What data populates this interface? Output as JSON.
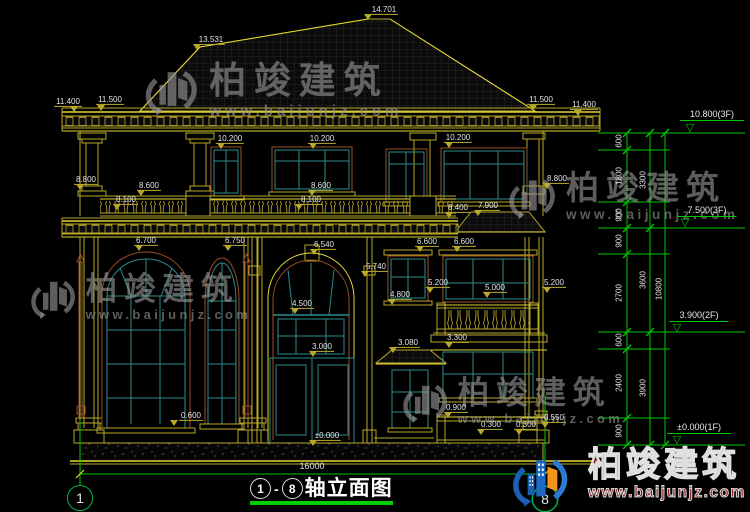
{
  "drawing": {
    "title_axis_start": "1",
    "title_axis_end": "8",
    "title_main": "轴立面图",
    "title_dash": "-",
    "total_width_dim": "16000",
    "axis_start": "1",
    "axis_end": "8"
  },
  "watermark": {
    "brand": "柏竣建筑",
    "url": "www.baijunjz.com"
  },
  "logo": {
    "brand": "柏竣建筑",
    "url": "www.baijunjz.com"
  },
  "colors": {
    "background": "#000000",
    "line_yellow": "#b9a82a",
    "line_bright": "#e2d535",
    "window_teal": "#2e8b8b",
    "frame_brown": "#9a4f28",
    "dim_green": "#00c800",
    "text_white": "#e3e3e3",
    "logo_blue": "#1a5fb4",
    "logo_orange": "#f5941d",
    "logo_red": "#8c1616"
  },
  "watermark_positions": [
    {
      "x": 142,
      "y": 56,
      "s": 1.12
    },
    {
      "x": 506,
      "y": 166,
      "s": 1.0
    },
    {
      "x": 28,
      "y": 268,
      "s": 0.96
    },
    {
      "x": 400,
      "y": 372,
      "s": 0.96
    }
  ],
  "dim_labels": [
    {
      "t": "14.701",
      "x": 384,
      "y": 10,
      "tx": 368,
      "ty": 14
    },
    {
      "t": "13.531",
      "x": 211,
      "y": 40,
      "tx": 197,
      "ty": 44
    },
    {
      "t": "11.400",
      "x": 68,
      "y": 102,
      "tx": 74,
      "ty": 106
    },
    {
      "t": "11.500",
      "x": 110,
      "y": 100,
      "tx": 101,
      "ty": 105
    },
    {
      "t": "11.500",
      "x": 541,
      "y": 100,
      "tx": 533,
      "ty": 105
    },
    {
      "t": "11.400",
      "x": 584,
      "y": 105,
      "tx": 578,
      "ty": 110
    },
    {
      "t": "10.200",
      "x": 230,
      "y": 139,
      "tx": 221,
      "ty": 143
    },
    {
      "t": "10.200",
      "x": 322,
      "y": 139,
      "tx": 313,
      "ty": 143
    },
    {
      "t": "10.200",
      "x": 458,
      "y": 138,
      "tx": 449,
      "ty": 142
    },
    {
      "t": "8.800",
      "x": 86,
      "y": 180,
      "tx": 80,
      "ty": 184
    },
    {
      "t": "8.600",
      "x": 149,
      "y": 186,
      "tx": 141,
      "ty": 190
    },
    {
      "t": "8.100",
      "x": 126,
      "y": 200,
      "tx": 117,
      "ty": 204
    },
    {
      "t": "8.600",
      "x": 321,
      "y": 186,
      "tx": 312,
      "ty": 190
    },
    {
      "t": "8.100",
      "x": 311,
      "y": 200,
      "tx": 299,
      "ty": 204
    },
    {
      "t": "8.400",
      "x": 458,
      "y": 208,
      "tx": 449,
      "ty": 212
    },
    {
      "t": "8.800",
      "x": 557,
      "y": 179,
      "tx": 547,
      "ty": 183
    },
    {
      "t": "7.900",
      "x": 488,
      "y": 206,
      "tx": 478,
      "ty": 210
    },
    {
      "t": "6.700",
      "x": 146,
      "y": 241,
      "tx": 139,
      "ty": 245
    },
    {
      "t": "6.750",
      "x": 235,
      "y": 241,
      "tx": 228,
      "ty": 245
    },
    {
      "t": "6.540",
      "x": 324,
      "y": 245,
      "tx": 314,
      "ty": 249
    },
    {
      "t": "6.600",
      "x": 427,
      "y": 242,
      "tx": 420,
      "ty": 246
    },
    {
      "t": "6.600",
      "x": 464,
      "y": 242,
      "tx": 457,
      "ty": 246
    },
    {
      "t": "5.740",
      "x": 376,
      "y": 267,
      "tx": 365,
      "ty": 271
    },
    {
      "t": "5.200",
      "x": 438,
      "y": 283,
      "tx": 430,
      "ty": 287
    },
    {
      "t": "5.000",
      "x": 495,
      "y": 288,
      "tx": 487,
      "ty": 292
    },
    {
      "t": "5.200",
      "x": 554,
      "y": 283,
      "tx": 547,
      "ty": 287
    },
    {
      "t": "4.800",
      "x": 400,
      "y": 295,
      "tx": 392,
      "ty": 299
    },
    {
      "t": "4.500",
      "x": 302,
      "y": 304,
      "tx": 295,
      "ty": 308
    },
    {
      "t": "3.300",
      "x": 457,
      "y": 338,
      "tx": 449,
      "ty": 342
    },
    {
      "t": "3.080",
      "x": 408,
      "y": 343,
      "tx": 393,
      "ty": 347
    },
    {
      "t": "3.000",
      "x": 322,
      "y": 347,
      "tx": 313,
      "ty": 351
    },
    {
      "t": "0.600",
      "x": 191,
      "y": 416,
      "tx": 174,
      "ty": 420
    },
    {
      "t": "0.900",
      "x": 456,
      "y": 408,
      "tx": 448,
      "ty": 412
    },
    {
      "t": "0.300",
      "x": 491,
      "y": 425,
      "tx": 481,
      "ty": 429
    },
    {
      "t": "0.300",
      "x": 526,
      "y": 425,
      "tx": 519,
      "ty": 429
    },
    {
      "t": "0.550",
      "x": 554,
      "y": 418,
      "tx": 545,
      "ty": 422
    },
    {
      "t": "±0.000",
      "x": 327,
      "y": 436,
      "tx": 313,
      "ty": 440
    }
  ],
  "right_chain": {
    "marker_glyph": "▽",
    "segments": [
      {
        "t": "600",
        "x": 619,
        "y": 141
      },
      {
        "t": "1800",
        "x": 619,
        "y": 176
      },
      {
        "t": "900",
        "x": 619,
        "y": 215
      },
      {
        "t": "900",
        "x": 619,
        "y": 241
      },
      {
        "t": "2700",
        "x": 619,
        "y": 293
      },
      {
        "t": "600",
        "x": 619,
        "y": 340
      },
      {
        "t": "2400",
        "x": 619,
        "y": 383
      },
      {
        "t": "900",
        "x": 619,
        "y": 431
      }
    ],
    "subtotals": [
      {
        "t": "3300",
        "x": 643,
        "y": 180
      },
      {
        "t": "3600",
        "x": 643,
        "y": 280
      },
      {
        "t": "3900",
        "x": 643,
        "y": 388
      }
    ],
    "totals": [
      {
        "t": "10800",
        "x": 659,
        "y": 289
      }
    ],
    "floor_marks": [
      {
        "t": "10.800(3F)",
        "x": 712,
        "y": 121,
        "ty": 124
      },
      {
        "t": "7.500(3F)",
        "x": 707,
        "y": 217,
        "ty": 219
      },
      {
        "t": "3.900(2F)",
        "x": 699,
        "y": 322,
        "ty": 324
      },
      {
        "t": "±0.000(1F)",
        "x": 699,
        "y": 434,
        "ty": 436
      }
    ]
  }
}
